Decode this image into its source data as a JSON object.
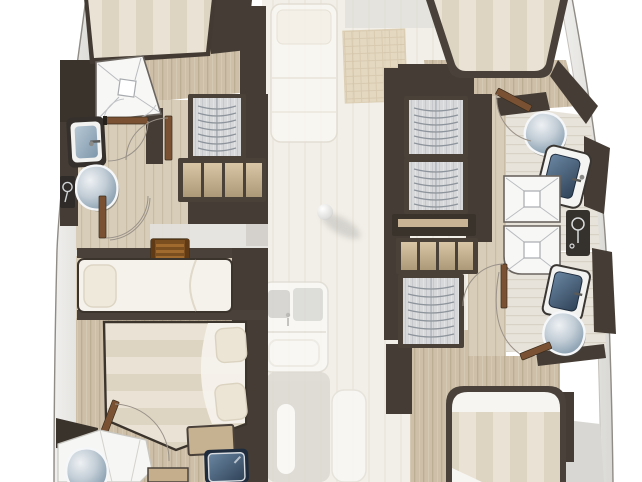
{
  "title": "Catamaran lower-deck interior floor plan (top-down)",
  "view": "top-down yacht layout, bow at top, ghosted bridgedeck saloon in center",
  "regions": {
    "port_hull": {
      "label": "port-hull",
      "rooms": [
        "forward-cabin",
        "forward-head",
        "midship-berth",
        "aft-cabin",
        "aft-head"
      ],
      "fixtures": [
        "double-berth",
        "shower",
        "vanity-sink",
        "toilet",
        "hanging-locker",
        "drawer-steps",
        "companionway-steps",
        "single-berth",
        "double-bed",
        "pillows",
        "foot-locker",
        "aft-toilet",
        "aft-sink"
      ]
    },
    "starboard_hull": {
      "label": "starboard-hull",
      "rooms": [
        "forward-cabin",
        "forward-head",
        "aft-head",
        "aft-cabin"
      ],
      "fixtures": [
        "double-berth",
        "hanging-locker-1",
        "hanging-locker-2",
        "hanging-locker-3",
        "drawer-steps",
        "toilet",
        "vanity-sink",
        "shower-1",
        "shower-2",
        "shower-control-panel",
        "aft-sink",
        "aft-toilet",
        "aft-double-bed"
      ]
    },
    "center": {
      "label": "bridgedeck-ghosted",
      "items": [
        "saloon-settee",
        "saloon-table",
        "galley-sink-unit",
        "galley-island",
        "galley-bench",
        "mast-step-ball",
        "side-deck-strips"
      ]
    }
  },
  "fixture_counts": {
    "toilets": 4,
    "sinks": 5,
    "showers": 4,
    "hanging_lockers": 4,
    "beds": 5,
    "door_swings": 8
  },
  "colors": {
    "background": "#ffffff",
    "center_sole": "#f2efe8",
    "wall_dark": "#453d35",
    "wall_darker": "#332d27",
    "wood_floor": "#cdbfa8",
    "wood_plank_line": "#bcae95",
    "tile_floor": "#e8e3da",
    "mattress_stripe_a": "#eae3d5",
    "mattress_stripe_b": "#ddd4c2",
    "linen_white": "#f6f4ef",
    "pillow": "#efe9db",
    "locker_interior": "#d7d8da",
    "hanger_arc": "#8d949b",
    "drawer_wood": "#d2bf9f",
    "companionway_wood": "#7b4e1f",
    "toilet_ceramic_light": "#eef1f4",
    "toilet_ceramic_dark": "#7e94a6",
    "sink_basin_blue": "#8aa2b4",
    "sink_basin_navy": "#2f4257",
    "door_leaf_brown": "#7a5233",
    "door_arc_gray": "#9a9289",
    "hull_band": "#e8e7e4",
    "hull_outline": "#8f8b85",
    "ghost_table_tan": "#dcc9a8",
    "ghost_white": "#faf8f4"
  }
}
